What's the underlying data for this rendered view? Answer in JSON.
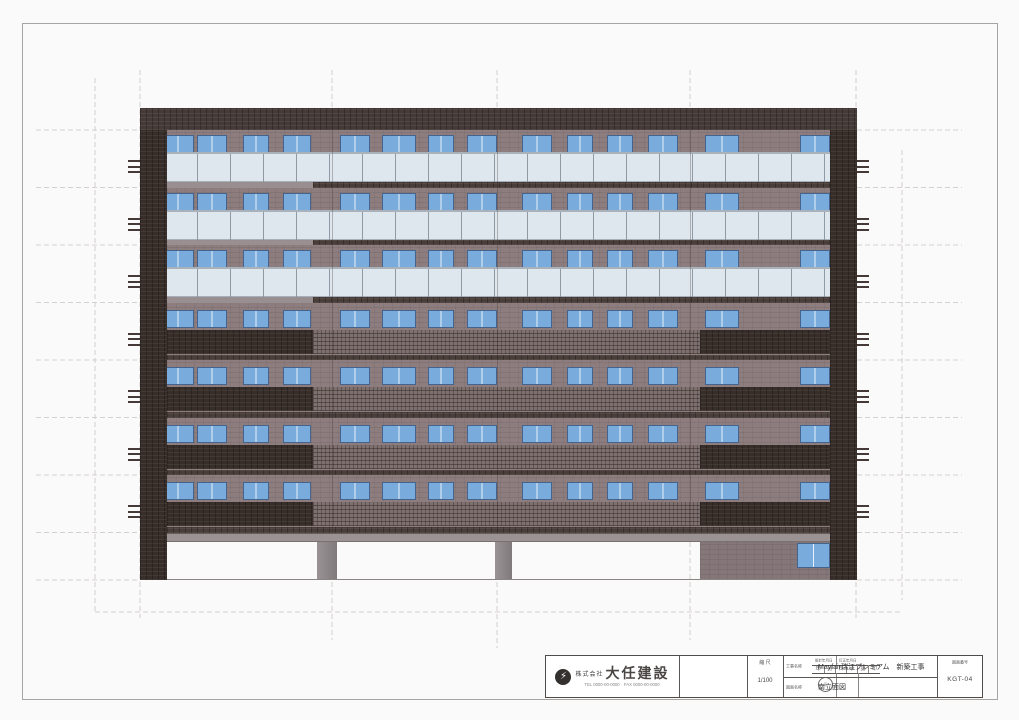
{
  "page": {
    "background": "#fbfafa",
    "frame_color": "#a8a4a2"
  },
  "title_block": {
    "company": {
      "logo_icon": "lightning-circle-logo",
      "prefix": "株式会社",
      "name": "大任建設",
      "contact": "TEL 0000-00-0000　FAX 0000-00-0000"
    },
    "approval": {
      "header_left": "設計年月日",
      "header_right": "訂正年月日",
      "cells": [
        "年",
        "月",
        "日",
        "承",
        "認",
        "印"
      ],
      "stamp": "印"
    },
    "scale": {
      "label": "縮 尺",
      "value": "1/100"
    },
    "project": {
      "label": "工事名称",
      "value": "Mayfair瑞江プレミアム　新築工事"
    },
    "drawing": {
      "label": "図面名称",
      "value": "南立面図"
    },
    "number": {
      "label": "図面番号",
      "value": "KGT-04"
    }
  },
  "elevation": {
    "left": 140,
    "top": 108,
    "width": 717,
    "height": 472,
    "parapet_h": 22,
    "floor_pitch": 57.5,
    "wall_top": 22,
    "wall_bottom": 424.5,
    "slab_h": 9,
    "base": 472,
    "pilaster_w": 27,
    "floors": [
      {
        "railing": "glass"
      },
      {
        "railing": "glass"
      },
      {
        "railing": "glass"
      },
      {
        "railing": "mixed"
      },
      {
        "railing": "mixed"
      },
      {
        "railing": "mixed"
      },
      {
        "railing": "mixed"
      }
    ],
    "windows": [
      [
        22,
        32
      ],
      [
        57,
        30
      ],
      [
        103,
        26
      ],
      [
        143,
        28
      ],
      [
        200,
        30
      ],
      [
        242,
        34
      ],
      [
        288,
        26
      ],
      [
        327,
        30
      ],
      [
        382,
        30
      ],
      [
        427,
        26
      ],
      [
        467,
        26
      ],
      [
        508,
        30
      ],
      [
        565,
        34
      ],
      [
        660,
        30
      ]
    ],
    "mixed_sections": {
      "dark_left": [
        27,
        146
      ],
      "lattice": [
        173,
        387
      ],
      "dark_right": [
        560,
        130
      ]
    },
    "glass_span": [
      24,
      666
    ],
    "spandrel_light": [
      27,
      146
    ],
    "spandrel_dark": [
      173,
      517
    ],
    "facade_lines": [
      192,
      357,
      550
    ],
    "ground": {
      "columns": [
        [
          177,
          20
        ],
        [
          355,
          17
        ]
      ],
      "wall": [
        560,
        130
      ],
      "wall_window": [
        657,
        33,
        25
      ]
    },
    "grid": {
      "verticals": [
        [
          95,
          78,
          612
        ],
        [
          140,
          70,
          618
        ],
        [
          332,
          70,
          640
        ],
        [
          497,
          70,
          648
        ],
        [
          690,
          70,
          640
        ],
        [
          856,
          70,
          618
        ],
        [
          902,
          150,
          600
        ]
      ],
      "floor_lines": [
        130,
        187.5,
        245,
        302.5,
        360,
        417.5,
        475,
        532.5,
        580
      ],
      "left_seg": [
        36,
        140
      ],
      "right_seg": [
        857,
        962
      ],
      "extra_horizontal": [
        [
          95,
          902,
          612
        ]
      ]
    },
    "colors": {
      "wall": "#8d7d7e",
      "parapet": "#453a37",
      "dark_band": "#372e2a",
      "lattice": "#7e706e",
      "glass": "#dfe7ee",
      "glass_rail": "#a9b2bb",
      "window": "#79acdc",
      "window_frame": "#44648e",
      "spandrel": "#4a3e3a",
      "spandrel_light": "#9a8f90",
      "slab": "#9b9294",
      "column": "#8b8486",
      "ground_wall": "#857779",
      "ground_line": "#8a8583",
      "tick": "#453a37",
      "facade_line": "rgba(55,42,40,0.30)",
      "grid_line": "#c9c3c1"
    }
  }
}
